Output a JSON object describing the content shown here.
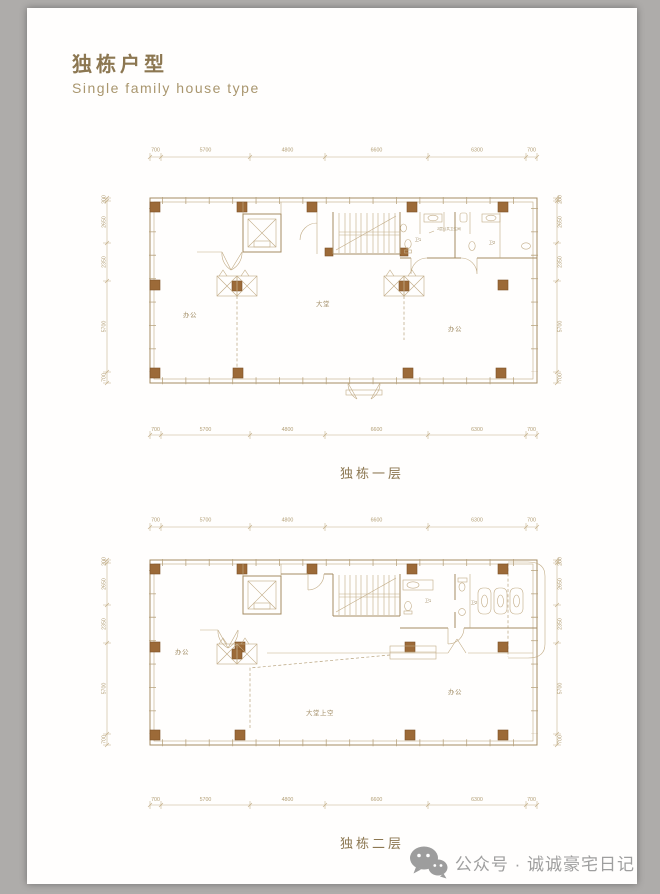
{
  "page": {
    "title": "独栋户型",
    "subtitle": "Single family house type"
  },
  "plans": {
    "dims_h": [
      "700",
      "5700",
      "4800",
      "6600",
      "6300",
      "700"
    ],
    "dims_v": [
      "200",
      "2650",
      "2350",
      "5700",
      "700"
    ]
  },
  "floor1": {
    "caption": "独栋一层",
    "rooms": {
      "left": "办公",
      "center": "大堂",
      "right": "办公",
      "wc1": "卫1",
      "wc2": "卫2",
      "wc_note": "2层公共卫生间"
    }
  },
  "floor2": {
    "caption": "独栋二层",
    "rooms": {
      "left": "办公",
      "center": "大堂上空",
      "right": "办公",
      "wc1": "卫1",
      "wc2": "卫2"
    }
  },
  "watermark": {
    "text": "公众号 · 诚诚豪宅日记"
  }
}
